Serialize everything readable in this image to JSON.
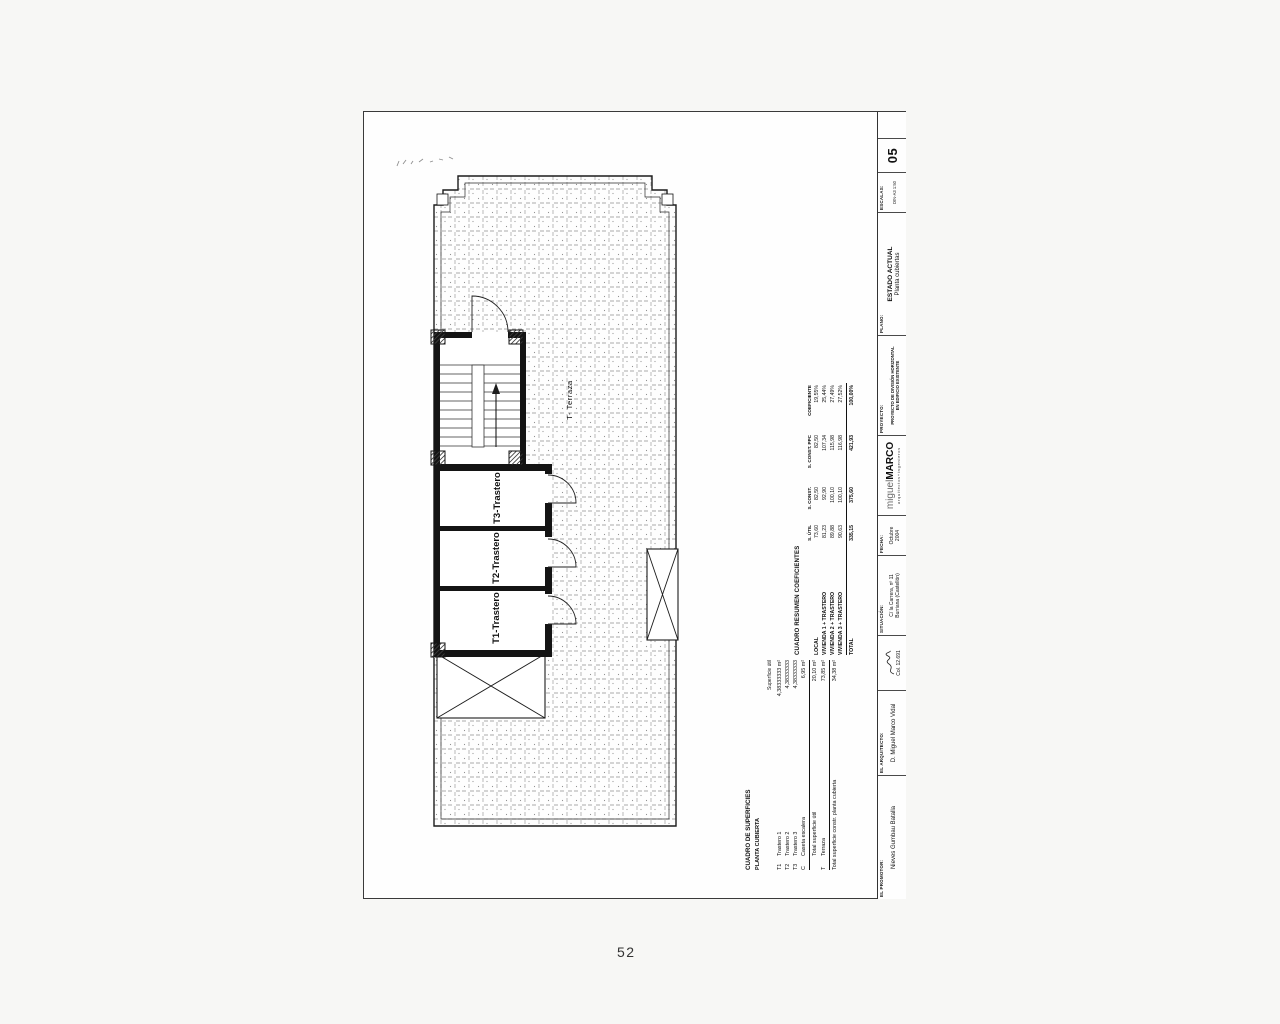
{
  "page": {
    "number": "52"
  },
  "plan": {
    "labels": {
      "t1": "T1-Trastero",
      "t2": "T2-Trastero",
      "t3": "T3-Trastero",
      "terraza": "T- Terraza"
    }
  },
  "surface_table": {
    "title": "CUADRO DE SUPERFICIES",
    "subtitle": "PLANTA CUBIERTA",
    "value_header": "Superficie útil",
    "rows": [
      {
        "code": "T1",
        "name": "Trastero 1",
        "value": "4,38333333 m²"
      },
      {
        "code": "T2",
        "name": "Trastero 2",
        "value": "4,38333333"
      },
      {
        "code": "T3",
        "name": "Trastero 3",
        "value": "4,38333333"
      },
      {
        "code": "C",
        "name": "Caseta escalera",
        "value": "6,95 m²"
      }
    ],
    "total_util": {
      "label": "Total superficie útil",
      "value": "20,10 m²"
    },
    "terraza_row": {
      "code": "T",
      "name": "Terraza",
      "value": "73,85 m²"
    },
    "total_const": {
      "label": "Total superficie constr. planta cubierta",
      "value": "34,38 m²"
    }
  },
  "coef_table": {
    "title": "CUADRO RESUMEN COEFICIENTES",
    "headers": {
      "util": "S. ÚTIL",
      "const": "S. CONST.",
      "ppc": "S. CONST. PPC",
      "coef": "COEFICIENTE"
    },
    "rows": [
      {
        "name": "LOCAL",
        "util": "73,60",
        "const": "82,50",
        "ppc": "82,50",
        "coef": "19,55%"
      },
      {
        "name": "VIVIENDA 1 + TRASTERO",
        "util": "81,23",
        "const": "92,90",
        "ppc": "107,34",
        "coef": "25,44%"
      },
      {
        "name": "VIVIENDA 2 + TRASTERO",
        "util": "89,88",
        "const": "100,10",
        "ppc": "115,98",
        "coef": "27,49%"
      },
      {
        "name": "VIVIENDA 3 + TRASTERO",
        "util": "90,63",
        "const": "100,10",
        "ppc": "116,98",
        "coef": "27,52%"
      }
    ],
    "total": {
      "name": "TOTAL",
      "util": "335,15",
      "const": "375,60",
      "ppc": "421,93",
      "coef": "100,00%"
    }
  },
  "titleblock": {
    "promoter": {
      "label": "EL PROMOTOR:",
      "name": "Nieves Gumbau Batalla"
    },
    "architect": {
      "label": "EL ARQUITECTO:",
      "name": "D. Miguel Marco Vidal",
      "college": "Col. 12.691"
    },
    "situation": {
      "label": "SITUACIÓN:",
      "address": "C/ la Carrera, nº 11",
      "city": "Burriana (Castellón)"
    },
    "date": {
      "label": "FECHA:",
      "line1": "Octubre",
      "line2": "2004"
    },
    "logo": {
      "light": "miguel",
      "bold": "MARCO",
      "sub": "arquitectos+ingenieros"
    },
    "project": {
      "label": "PROYECTO:",
      "line1": "PROYECTO DE DIVISIÓN HORIZONTAL",
      "line2": "EN EDIFICIO EXISTENTE"
    },
    "plano": {
      "label": "PLANO:",
      "title": "ESTADO ACTUAL",
      "subtitle": "Planta cubiertas"
    },
    "scale": {
      "label": "ESCALAS:",
      "value": "DIN-A3  1:50"
    },
    "sheet_number": "05"
  }
}
